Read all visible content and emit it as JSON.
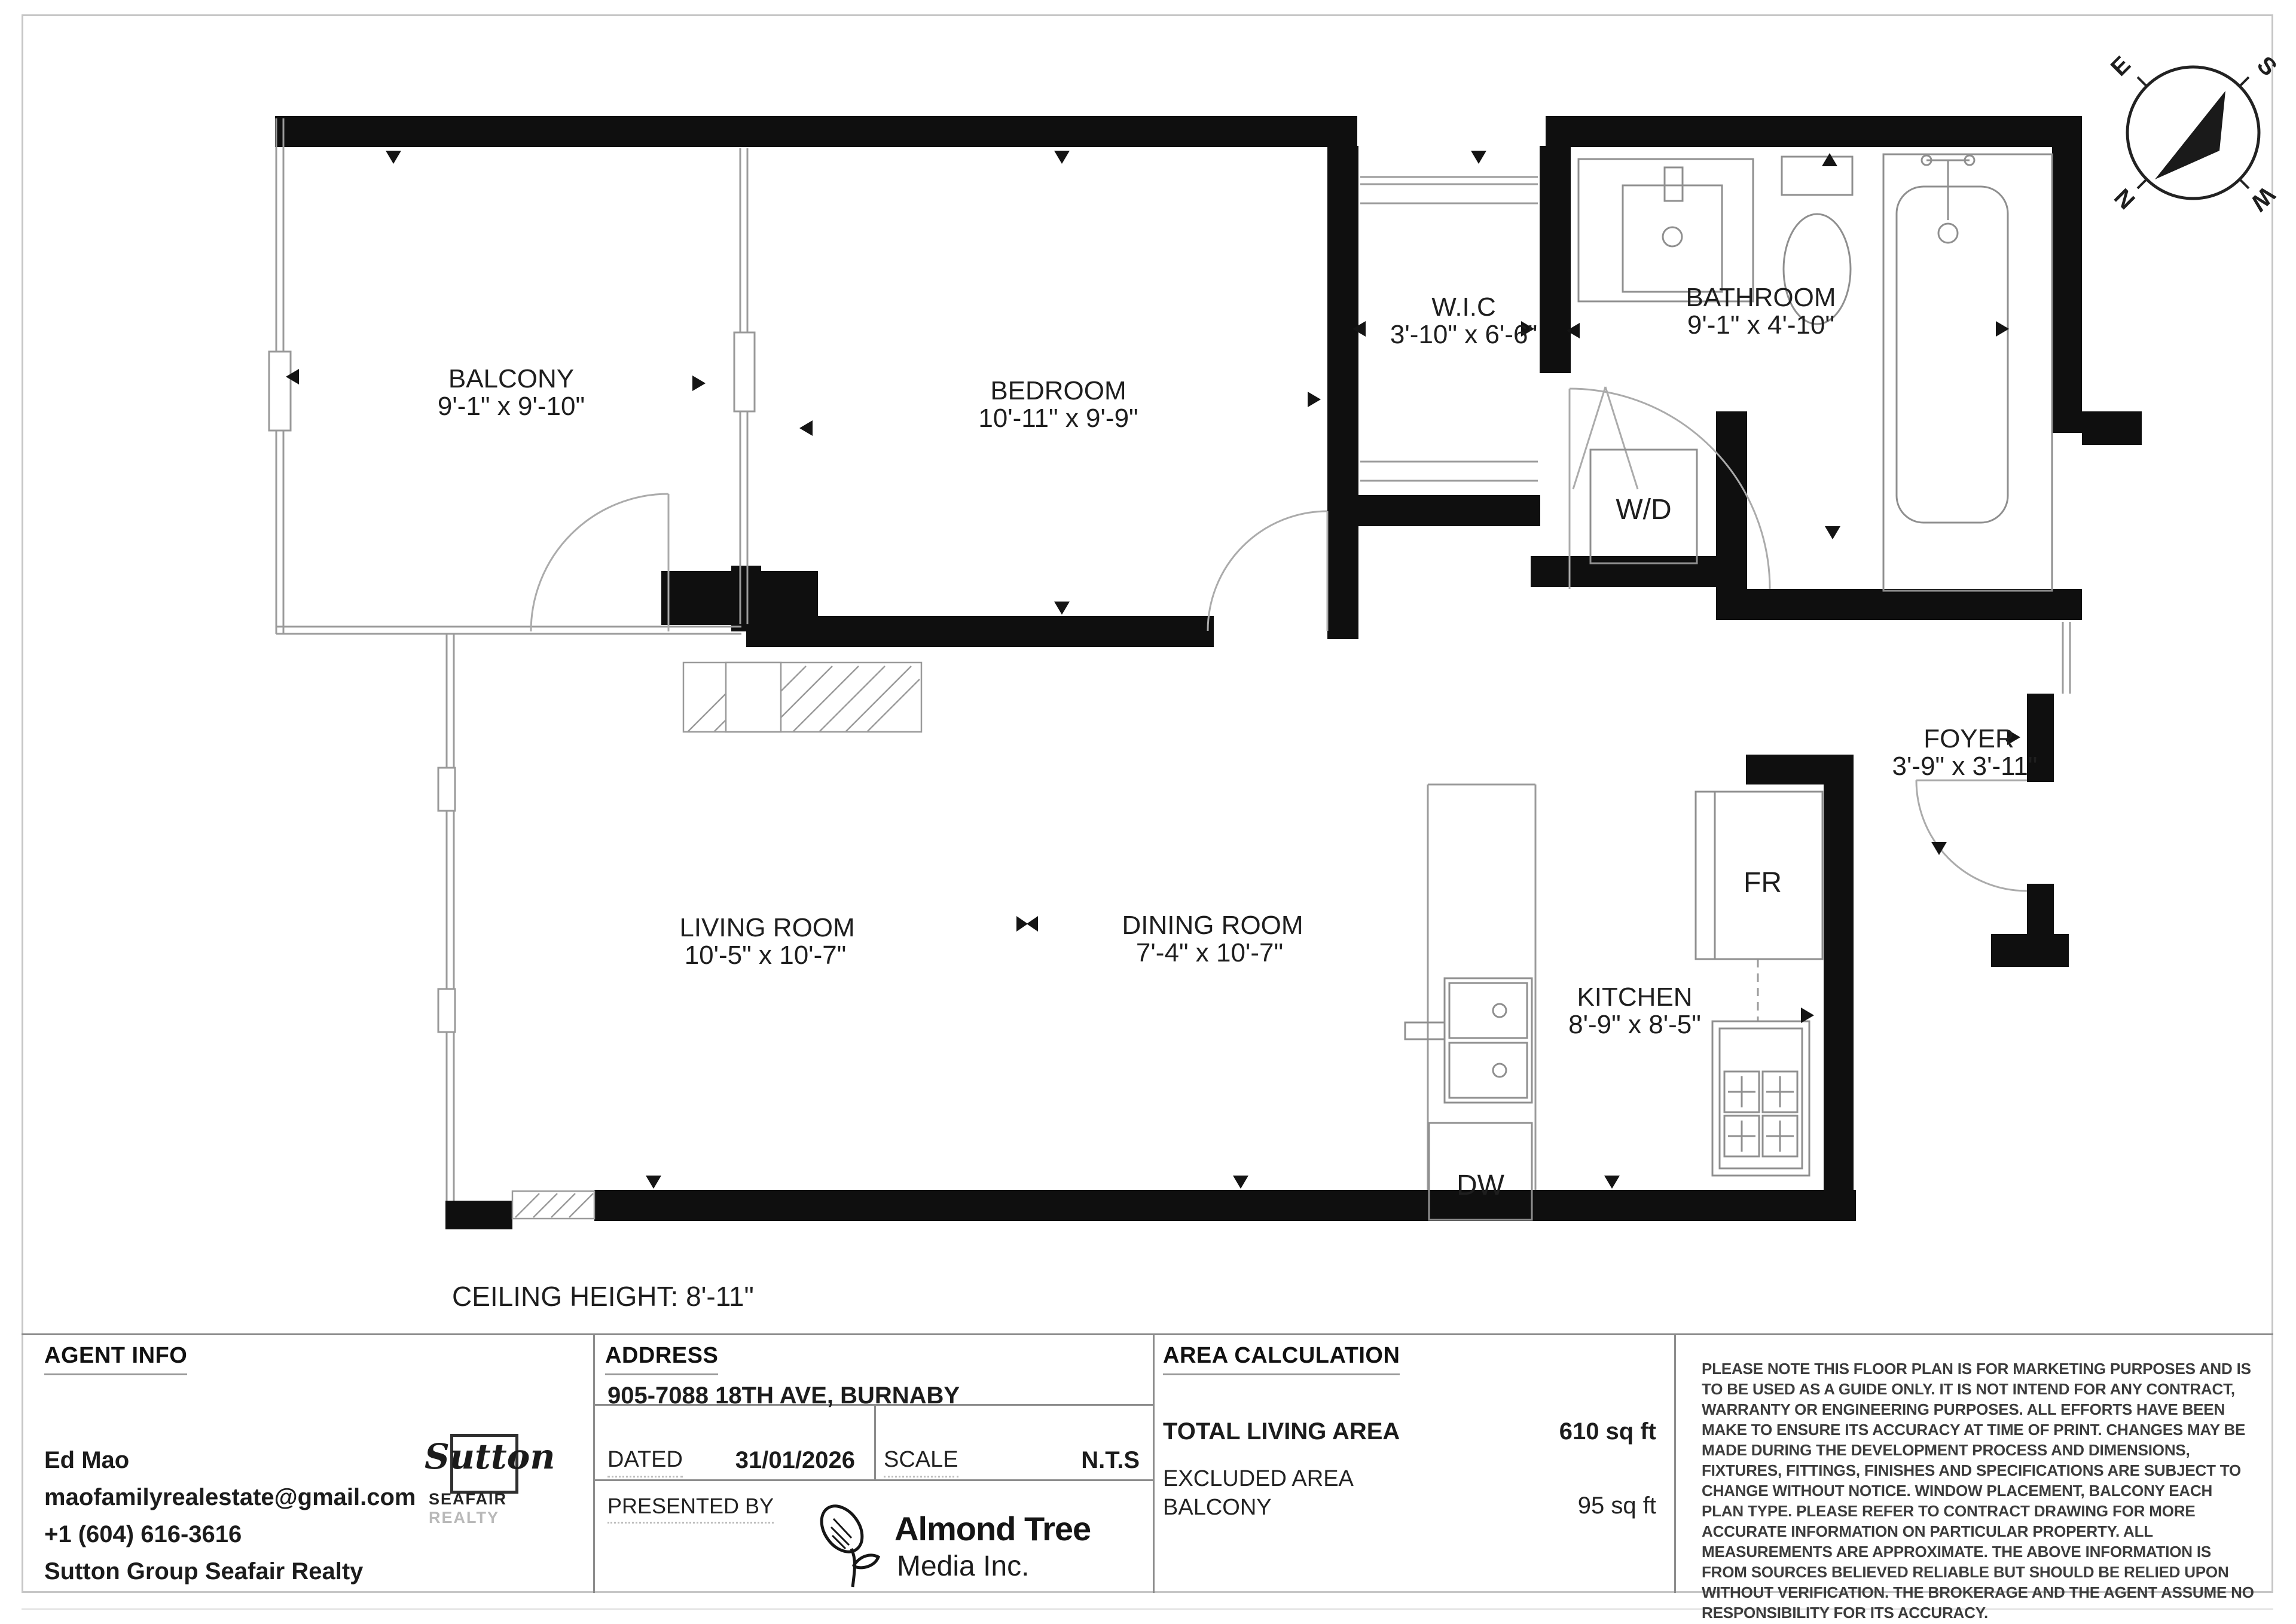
{
  "page": {
    "background": "#ffffff",
    "border_color": "#c6c6c6",
    "wall_color": "#0f0f0f",
    "fixture_color": "#8a8a8a"
  },
  "compass": {
    "e": "E",
    "s": "S",
    "n": "N",
    "w": "W"
  },
  "plan": {
    "rooms": [
      {
        "name": "BALCONY",
        "dims": "9'-1\" x 9'-10\""
      },
      {
        "name": "BEDROOM",
        "dims": "10'-11\" x 9'-9\""
      },
      {
        "name": "W.I.C",
        "dims": "3'-10\" x 6'-6\""
      },
      {
        "name": "BATHROOM",
        "dims": "9'-1\" x 4'-10\""
      },
      {
        "name": "LIVING ROOM",
        "dims": "10'-5\" x 10'-7\""
      },
      {
        "name": "DINING ROOM",
        "dims": "7'-4\" x 10'-7\""
      },
      {
        "name": "KITCHEN",
        "dims": "8'-9\" x 8'-5\""
      },
      {
        "name": "FOYER",
        "dims": "3'-9\" x 3'-11\""
      }
    ],
    "appliances": {
      "washer_dryer": "W/D",
      "fridge": "FR",
      "dishwasher": "DW"
    },
    "ceiling_height": "CEILING HEIGHT: 8'-11\""
  },
  "panel": {
    "agent": {
      "heading": "AGENT INFO",
      "name": "Ed Mao",
      "email": "maofamilyrealestate@gmail.com",
      "phone": "+1 (604) 616-3616",
      "brokerage": "Sutton Group Seafair Realty"
    },
    "sutton_logo": {
      "word": "Sutton",
      "sub_bold": "SEAFAIR",
      "sub_light": "REALTY"
    },
    "address": {
      "heading": "ADDRESS",
      "value": "905-7088 18TH AVE, BURNABY",
      "dated_label": "DATED",
      "dated_value": "31/01/2026",
      "scale_label": "SCALE",
      "scale_value": "N.T.S",
      "presented_label": "PRESENTED BY"
    },
    "presenter": {
      "line1": "Almond Tree",
      "line2": "Media Inc."
    },
    "area": {
      "heading": "AREA CALCULATION",
      "total_label": "TOTAL LIVING AREA",
      "total_value": "610 sq ft",
      "excluded_label": "EXCLUDED AREA",
      "excluded_item": "BALCONY",
      "excluded_value": "95 sq ft"
    },
    "disclaimer": "PLEASE NOTE THIS FLOOR PLAN IS FOR MARKETING PURPOSES AND IS TO BE USED AS A GUIDE ONLY. IT IS NOT INTEND FOR ANY CONTRACT, WARRANTY OR ENGINEERING PURPOSES. ALL EFFORTS HAVE BEEN MAKE TO ENSURE ITS ACCURACY AT TIME OF PRINT. CHANGES MAY BE MADE DURING THE DEVELOPMENT PROCESS AND DIMENSIONS, FIXTURES, FITTINGS, FINISHES AND SPECIFICATIONS ARE SUBJECT TO CHANGE WITHOUT NOTICE. WINDOW PLACEMENT, BALCONY EACH PLAN TYPE. PLEASE REFER TO CONTRACT DRAWING FOR MORE ACCURATE INFORMATION ON PARTICULAR PROPERTY. ALL MEASUREMENTS ARE APPROXIMATE. THE ABOVE INFORMATION IS FROM SOURCES BELIEVED RELIABLE BUT SHOULD BE RELIED UPON WITHOUT VERIFICATION. THE BROKERAGE AND THE AGENT ASSUME NO RESPONSIBILITY FOR ITS ACCURACY."
  }
}
